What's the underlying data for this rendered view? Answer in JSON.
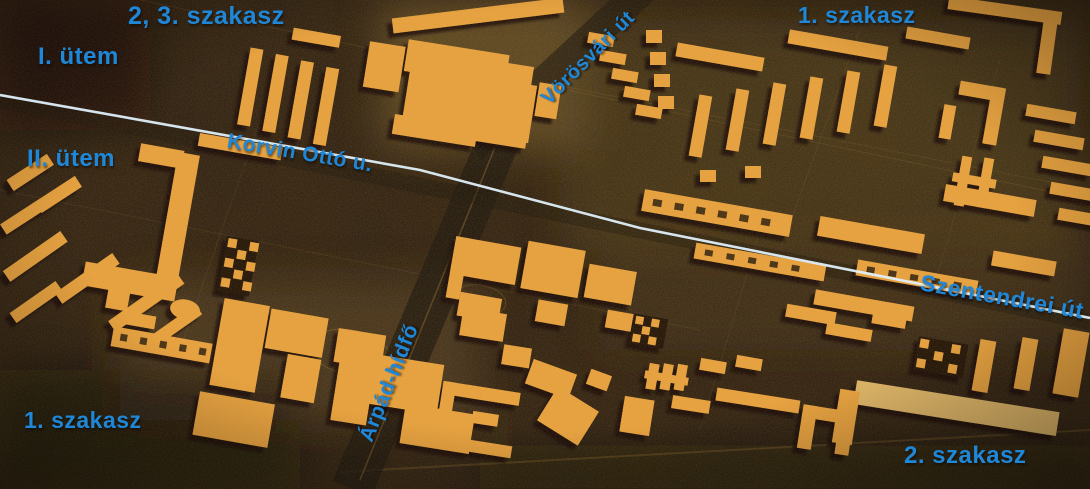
{
  "image": {
    "description": "Sepia aerial photograph of an architectural scale model of a housing estate (Óbuda), annotated with blue construction-phase and street labels and a pale blue phase-boundary line"
  },
  "labels": {
    "szakasz_2_3": "2, 3. szakasz",
    "utem_1": "I. ütem",
    "utem_2": "II. ütem",
    "szakasz_1_top": "1. szakasz",
    "korvin_otto_u": "Korvin Ottó u.",
    "vorosvari_ut": "Vörösvári út",
    "szentendrei_ut": "Szentendrei út",
    "arpad_hidfo": "Árpád-hídfő",
    "szakasz_1_bottom": "1. szakasz",
    "szakasz_2_bottom": "2. szakasz"
  },
  "colors": {
    "annotation_blue": "#1f87d8",
    "boundary_line_blue": "#dff0fa",
    "model_building_orange": "#e59d38",
    "photo_background_brown": "#281a0e"
  }
}
